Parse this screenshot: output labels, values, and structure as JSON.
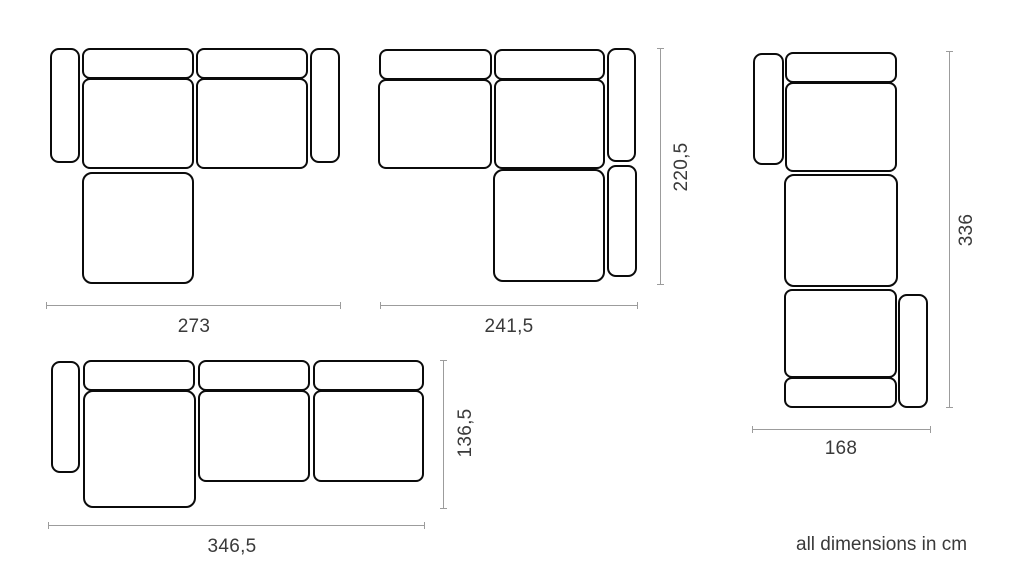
{
  "footer": {
    "note": "all dimensions in cm"
  },
  "colors": {
    "background": "#ffffff",
    "module_fill": "#ffffff",
    "module_outline": "#0b0b0b",
    "dimension_line": "#9c9c9c",
    "label_text": "#3a3a3a"
  },
  "figures": [
    {
      "id": "sofa-config-chaise-left-2seat",
      "modules": [
        {
          "name": "armrest-left",
          "x": 50,
          "y": 48,
          "w": 30,
          "h": 115,
          "r": 9
        },
        {
          "name": "backrest-1",
          "x": 82,
          "y": 48,
          "w": 112,
          "h": 31,
          "r": 8
        },
        {
          "name": "seat-1",
          "x": 82,
          "y": 78,
          "w": 112,
          "h": 91,
          "r": 8
        },
        {
          "name": "backrest-2",
          "x": 196,
          "y": 48,
          "w": 112,
          "h": 31,
          "r": 8
        },
        {
          "name": "seat-2",
          "x": 196,
          "y": 78,
          "w": 112,
          "h": 91,
          "r": 8
        },
        {
          "name": "armrest-right",
          "x": 310,
          "y": 48,
          "w": 30,
          "h": 115,
          "r": 9
        },
        {
          "name": "chaise-seat",
          "x": 82,
          "y": 172,
          "w": 112,
          "h": 112,
          "r": 10
        }
      ],
      "dimensions": [
        {
          "orientation": "horizontal",
          "label": "273",
          "x": 46,
          "y": 305,
          "length": 295,
          "label_x": 194,
          "label_y": 327,
          "rotated": false
        }
      ]
    },
    {
      "id": "sofa-config-chaise-right-2seat",
      "modules": [
        {
          "name": "backrest-1",
          "x": 379,
          "y": 49,
          "w": 113,
          "h": 31,
          "r": 8
        },
        {
          "name": "seat-1",
          "x": 378,
          "y": 79,
          "w": 114,
          "h": 90,
          "r": 8
        },
        {
          "name": "backrest-2",
          "x": 494,
          "y": 49,
          "w": 111,
          "h": 31,
          "r": 8
        },
        {
          "name": "seat-2",
          "x": 494,
          "y": 79,
          "w": 111,
          "h": 90,
          "r": 8
        },
        {
          "name": "armrest-right-upper",
          "x": 607,
          "y": 48,
          "w": 29,
          "h": 114,
          "r": 9
        },
        {
          "name": "chaise-seat",
          "x": 493,
          "y": 169,
          "w": 112,
          "h": 113,
          "r": 10
        },
        {
          "name": "armrest-right-lower",
          "x": 607,
          "y": 165,
          "w": 30,
          "h": 112,
          "r": 9
        }
      ],
      "dimensions": [
        {
          "orientation": "vertical",
          "label": "220,5",
          "x": 660,
          "y": 48,
          "length": 237,
          "label_x": 682,
          "label_y": 167,
          "rotated": true
        },
        {
          "orientation": "horizontal",
          "label": "241,5",
          "x": 380,
          "y": 305,
          "length": 258,
          "label_x": 509,
          "label_y": 327,
          "rotated": false
        }
      ]
    },
    {
      "id": "sofa-config-vertical-3seat",
      "modules": [
        {
          "name": "armrest-left",
          "x": 753,
          "y": 53,
          "w": 31,
          "h": 112,
          "r": 9
        },
        {
          "name": "backrest-top",
          "x": 785,
          "y": 52,
          "w": 112,
          "h": 31,
          "r": 8
        },
        {
          "name": "seat-1",
          "x": 785,
          "y": 82,
          "w": 112,
          "h": 90,
          "r": 8
        },
        {
          "name": "seat-2",
          "x": 784,
          "y": 174,
          "w": 114,
          "h": 113,
          "r": 10
        },
        {
          "name": "seat-3",
          "x": 784,
          "y": 289,
          "w": 113,
          "h": 89,
          "r": 8
        },
        {
          "name": "backrest-bottom",
          "x": 784,
          "y": 377,
          "w": 113,
          "h": 31,
          "r": 8
        },
        {
          "name": "armrest-right",
          "x": 898,
          "y": 294,
          "w": 30,
          "h": 114,
          "r": 9
        }
      ],
      "dimensions": [
        {
          "orientation": "vertical",
          "label": "336",
          "x": 949,
          "y": 51,
          "length": 357,
          "label_x": 967,
          "label_y": 230,
          "rotated": true
        },
        {
          "orientation": "horizontal",
          "label": "168",
          "x": 752,
          "y": 429,
          "length": 179,
          "label_x": 841,
          "label_y": 449,
          "rotated": false
        }
      ]
    },
    {
      "id": "sofa-config-chaise-left-3seat",
      "modules": [
        {
          "name": "armrest-left",
          "x": 51,
          "y": 361,
          "w": 29,
          "h": 112,
          "r": 9
        },
        {
          "name": "backrest-1",
          "x": 83,
          "y": 360,
          "w": 112,
          "h": 31,
          "r": 8
        },
        {
          "name": "chaise-seat",
          "x": 83,
          "y": 390,
          "w": 113,
          "h": 118,
          "r": 10
        },
        {
          "name": "backrest-2",
          "x": 198,
          "y": 360,
          "w": 112,
          "h": 31,
          "r": 8
        },
        {
          "name": "seat-2",
          "x": 198,
          "y": 390,
          "w": 112,
          "h": 92,
          "r": 8
        },
        {
          "name": "backrest-3",
          "x": 313,
          "y": 360,
          "w": 111,
          "h": 31,
          "r": 8
        },
        {
          "name": "seat-3",
          "x": 313,
          "y": 390,
          "w": 111,
          "h": 92,
          "r": 8
        }
      ],
      "dimensions": [
        {
          "orientation": "vertical",
          "label": "136,5",
          "x": 443,
          "y": 360,
          "length": 149,
          "label_x": 466,
          "label_y": 433,
          "rotated": true
        },
        {
          "orientation": "horizontal",
          "label": "346,5",
          "x": 48,
          "y": 525,
          "length": 377,
          "label_x": 232,
          "label_y": 547,
          "rotated": false
        }
      ]
    }
  ]
}
